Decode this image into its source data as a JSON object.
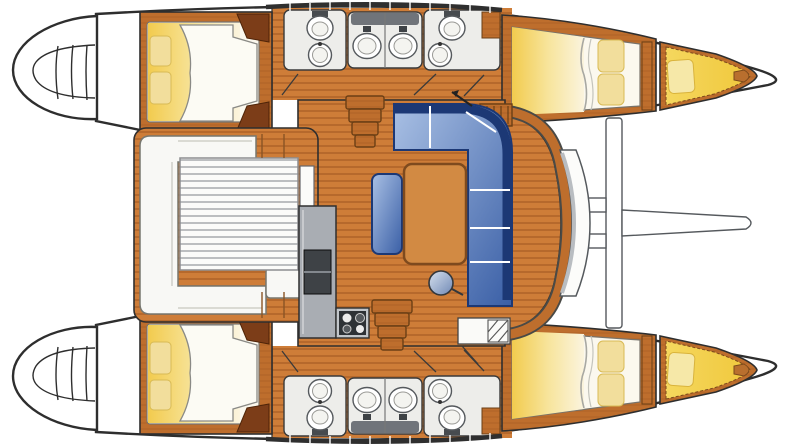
{
  "meta": {
    "title": "Catamaran sailboat interior layout plan — top-down view, bow to the right",
    "diagram_type": "boat-floor-plan",
    "orientation": "bow-right, stern-left; port hull at top, starboard hull at bottom"
  },
  "palette": {
    "hull-outline": "#2e2e2e",
    "teak-floor": "#ce7d38",
    "teak-stripe": "#b4672a",
    "wood-frame": "#be6e2d",
    "wood-grain": "#a55e23",
    "wood-dark": "#7c3d18",
    "bed-yellow": "#f2cb4e",
    "bed-cream": "#fbf4de",
    "duvet-white": "#fcfbf4",
    "pillow-cream": "#f2de9c",
    "settee-navy": "#1c3875",
    "settee-blue-light": "#a9c0e4",
    "settee-blue-dark": "#3a5fa6",
    "table-tan": "#d28a43",
    "table-border": "#7e4a1e",
    "counter-gray": "#a9adb3",
    "head-counter": "#ededea",
    "appliance-dark": "#3e4246",
    "fixture-white": "#ffffff",
    "fixture-outline": "#55595d",
    "cushion-gold": "#f0c83c",
    "slat-line": "#adafb2",
    "bench-white": "#f8f8f5"
  },
  "vessel": {
    "type_label": "sailing catamaran, 4-cabin layout",
    "areas": [
      {
        "id": "cockpit",
        "label": "aft cockpit with U-shaped bench and slatted table"
      },
      {
        "id": "saloon",
        "label": "saloon with L-shaped blue settee, dining table and stool"
      },
      {
        "id": "galley",
        "label": "galley with counter, fridge and 4-burner stove"
      },
      {
        "id": "port-aft-cabin",
        "label": "port aft double cabin"
      },
      {
        "id": "port-heads",
        "label": "port bathrooms with toilets, sinks and twin basins"
      },
      {
        "id": "port-forward-cabin",
        "label": "port forward double cabin"
      },
      {
        "id": "port-forepeak",
        "label": "port forepeak berth"
      },
      {
        "id": "starboard-aft-cabin",
        "label": "starboard aft double cabin"
      },
      {
        "id": "starboard-heads",
        "label": "starboard bathrooms with toilets, sinks and twin basins"
      },
      {
        "id": "starboard-forward-cabin",
        "label": "starboard forward double cabin"
      },
      {
        "id": "starboard-forepeak",
        "label": "starboard forepeak berth"
      },
      {
        "id": "foredeck",
        "label": "foredeck with crossbeam and bowsprit"
      },
      {
        "id": "transoms",
        "label": "twin stern transom platforms with steps"
      }
    ],
    "fixture_counts": {
      "double_berths": 4,
      "forepeak_berths": 2,
      "toilets": 4,
      "sinks": 8,
      "stove_burners": 4
    }
  }
}
